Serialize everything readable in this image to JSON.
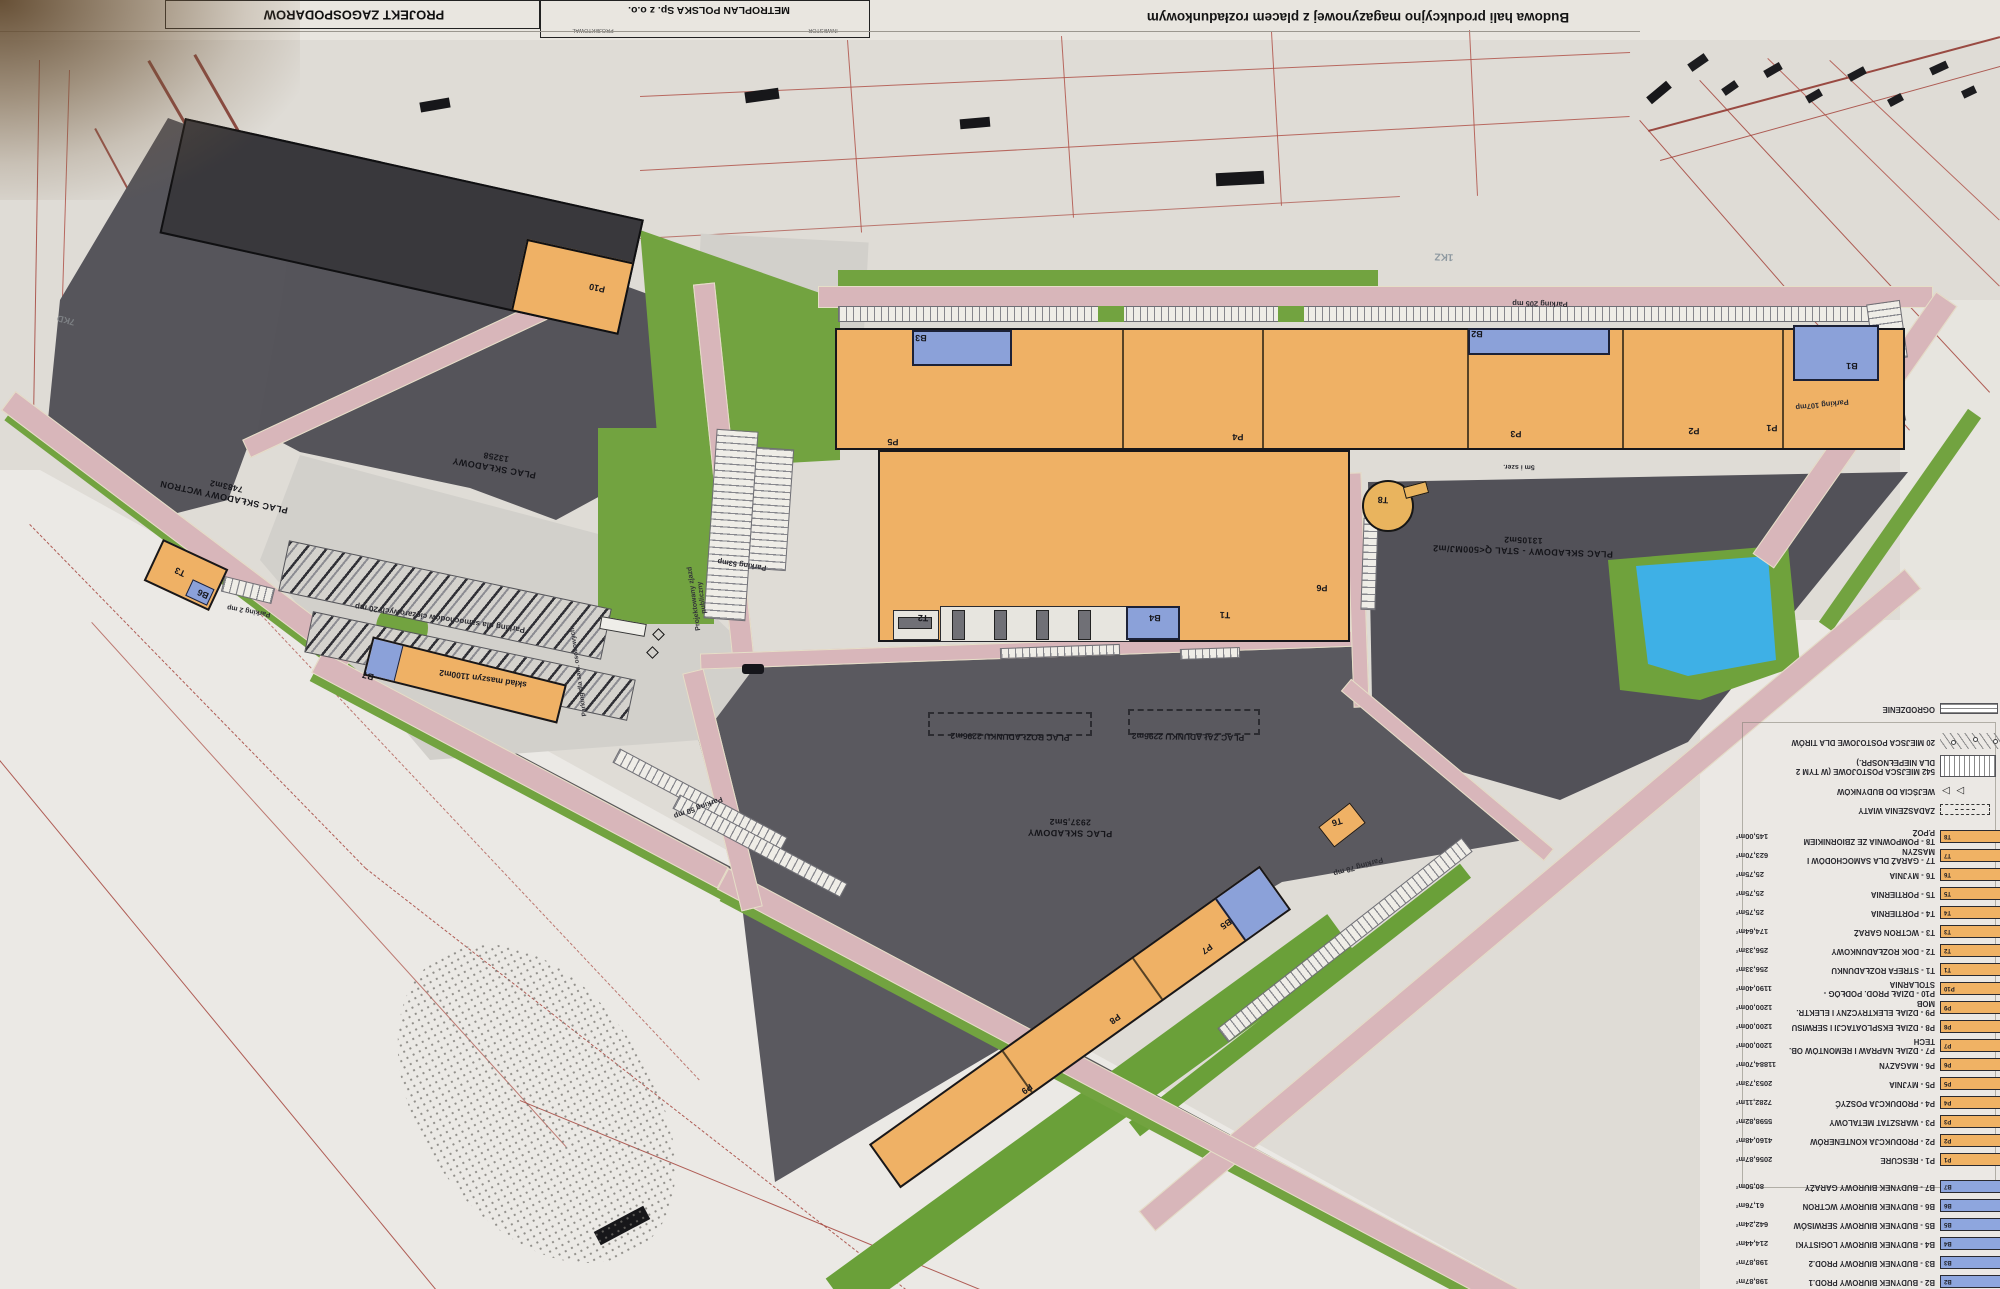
{
  "title_block": {
    "project": "PROJEKT ZAGOSPODAROW",
    "company": "METROPLAN POLSKA Sp. z o.o.",
    "cell_left": "PROJEKTOWAŁ",
    "cell_right": "INWESTOR",
    "drawing_title": "Budowa hali produkcyjno magazynowej z placem rozładunkowym"
  },
  "plan": {
    "yards": {
      "wctron": {
        "name": "PLAC SKŁADOWY WCTRON",
        "area": "7483m2"
      },
      "main": {
        "name": "PLAC SKŁADOWY",
        "area": "13258"
      },
      "steel": {
        "name": "PLAC SKŁADOWY - STAL Q<500MJ/m2",
        "area": "13105m2"
      },
      "south": {
        "name": "PLAC SKŁADOWY",
        "area": "2937,5m2"
      }
    },
    "zones": {
      "unloading": "PLAC ROZŁADUNKU 2296m2",
      "loading": "PLAC ZAŁADUNKU 2296m2",
      "machines": "skład maszyn 1100m2"
    },
    "parking": {
      "p205": "Parking 205 mp",
      "p107": "Parking 107mp",
      "p53": "Parking 53mp",
      "p50": "Parking 50 mp",
      "p78": "Parking 78 mp",
      "p2": "Parking 2 mp",
      "trucks": "Parking dla samochodów ciężarowych 20 mp",
      "cars": "Parking dla sam. osobowych"
    },
    "roads": {
      "access_line1": "Projektowany zjazd",
      "access_line2": "publiczny",
      "note": "5m i szer."
    },
    "map_refs": {
      "kz": "1KZ",
      "kd": "7KD"
    },
    "building_tags": [
      "P1",
      "P2",
      "P3",
      "P4",
      "P5",
      "P6",
      "P7",
      "P8",
      "P9",
      "P10",
      "B1",
      "B2",
      "B3",
      "B4",
      "B5",
      "B6",
      "B7",
      "T1",
      "T2",
      "T3",
      "T6",
      "T8"
    ]
  },
  "legend": {
    "rows": [
      {
        "sym": "fence",
        "label": "OGRODZENIE",
        "area": ""
      },
      {
        "sym": "tir",
        "label": "20 MIEJSCA POSTOJOWE DLA TIRÓW",
        "area": ""
      },
      {
        "sym": "stripes",
        "label": "542 MIEJSCA POSTOJOWE (W TYM 2 DLA NIEPEŁNOSPR.)",
        "area": ""
      },
      {
        "sym": "arrows",
        "label": "WEJŚCIA DO BUDYNKÓW",
        "area": ""
      },
      {
        "sym": "canopy",
        "label": "ZADASZENIA WIATY",
        "area": ""
      },
      {
        "sym": "or",
        "tag": "T8",
        "label": "T8 - POMPOWNIA ZE ZBIORNIKIEM P.POŻ",
        "area": "145,00m²"
      },
      {
        "sym": "or",
        "tag": "T7",
        "label": "T7 - GARAŻ DLA SAMOCHODÓW I MASZYN",
        "area": "623,70m²"
      },
      {
        "sym": "or",
        "tag": "T6",
        "label": "T6 - MYJNIA",
        "area": "25,75m²"
      },
      {
        "sym": "or",
        "tag": "T5",
        "label": "T5 - PORTIERNIA",
        "area": "25,75m²"
      },
      {
        "sym": "or",
        "tag": "T4",
        "label": "T4 - PORTIERNIA",
        "area": "25,75m²"
      },
      {
        "sym": "or",
        "tag": "T3",
        "label": "T3 - WCTRON GARAŻ",
        "area": "174,64m²"
      },
      {
        "sym": "or",
        "tag": "T2",
        "label": "T2 - DOK ROZŁADUNKOWY",
        "area": "256,33m²"
      },
      {
        "sym": "or",
        "tag": "T1",
        "label": "T1 - STREFA ROZŁADUNKU",
        "area": "256,33m²"
      },
      {
        "sym": "or",
        "tag": "P10",
        "label": "P10 - DZIAŁ PROD. PODŁÓG - STOLARNIA",
        "area": "1190,40m²"
      },
      {
        "sym": "or",
        "tag": "P9",
        "label": "P9 - DZIAŁ ELEKTRYCZNY I ELEKTR. MOB",
        "area": "1200,00m²"
      },
      {
        "sym": "or",
        "tag": "P8",
        "label": "P8 - DZIAŁ EKSPLOATACJI I SERWISU",
        "area": "1200,00m²"
      },
      {
        "sym": "or",
        "tag": "P7",
        "label": "P7 - DZIAŁ NAPRAW I REMONTÓW OB. TECH",
        "area": "1200,00m²"
      },
      {
        "sym": "or",
        "tag": "P6",
        "label": "P6 - MAGAZYN",
        "area": "11884,70m²"
      },
      {
        "sym": "or",
        "tag": "P5",
        "label": "P5 - MYJNIA",
        "area": "2053,73m²"
      },
      {
        "sym": "or",
        "tag": "P4",
        "label": "P4 - PRODUKCJA POSZYĆ",
        "area": "7282,11m²"
      },
      {
        "sym": "or",
        "tag": "P3",
        "label": "P3 - WARSZTAT METALOWY",
        "area": "5598,82m²"
      },
      {
        "sym": "or",
        "tag": "P2",
        "label": "P2 - PRODUKCJA KONTENERÓW",
        "area": "4160,48m²"
      },
      {
        "sym": "or",
        "tag": "P1",
        "label": "P1 - RESCURE",
        "area": "2056,87m²"
      },
      {
        "sym": "bl",
        "tag": "B7",
        "label": "B7 - BUDYNEK BIUROWY GARAŻY",
        "area": "80,50m²"
      },
      {
        "sym": "bl",
        "tag": "B6",
        "label": "B6 - BUDYNEK BIUROWY WCTRON",
        "area": "61,76m²"
      },
      {
        "sym": "bl",
        "tag": "B5",
        "label": "B5 - BUDYNEK BIUROWY SERWISÓW",
        "area": "642,24m²"
      },
      {
        "sym": "bl",
        "tag": "B4",
        "label": "B4 - BUDYNEK BIUROWY LOGISTYKI",
        "area": "214,44m²"
      },
      {
        "sym": "bl",
        "tag": "B3",
        "label": "B3 - BUDYNEK BIUROWY PROD.2",
        "area": "198,87m²"
      },
      {
        "sym": "bl",
        "tag": "B2",
        "label": "B2 - BUDYNEK BIUROWY PROD.1",
        "area": "198,87m²"
      }
    ]
  }
}
